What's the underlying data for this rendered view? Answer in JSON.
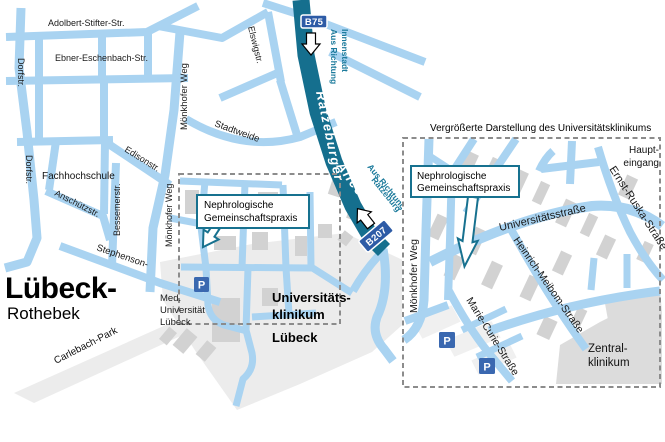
{
  "colors": {
    "road_light": "#a9d3f1",
    "road_dark": "#156f8e",
    "badge_blue": "#2d5ba6",
    "teal_text": "#1b7a9b",
    "callout_teal": "#17718f",
    "building_gray": "#d2d2d2",
    "campus_gray": "#ececec",
    "parking_blue": "#3a68b0"
  },
  "main_map": {
    "city_label": {
      "title": "Lübeck-",
      "subtitle": "Rothebek"
    },
    "streets": {
      "adolbert": "Adolbert-Stifter-Str.",
      "ebner": "Ebner-Eschenbach-Str.",
      "dorfstr_top": "Dorfstr.",
      "dorfstr_mid": "Dorfstr.",
      "moenkhofer_top": "Mönkhofer Weg",
      "moenkhofer_mid": "Mönkhofer Weg",
      "elswigstr": "Elswigstr.",
      "stadtweide": "Stadtweide",
      "edisonstr": "Edisonstr.",
      "bessemerstr": "Bessemerstr.",
      "anschuetzstr": "Anschützstr.",
      "stephenson": "Stephenson-",
      "ratzeburger": "Ratzeburger",
      "allee": "Allee",
      "carlebach_park": "Carlebach-Park"
    },
    "places": {
      "fachhochschule": "Fachhochschule",
      "med_uni_l1": "Med.",
      "med_uni_l2": "Universität",
      "med_uni_l3": "Lübeck",
      "klinikum_l1": "Universitäts-",
      "klinikum_l2": "klinikum",
      "klinikum_l3": "Lübeck"
    },
    "badges": {
      "b75": "B75",
      "b207": "B207"
    },
    "direction_innenstadt_l1": "Aus Richtung",
    "direction_innenstadt_l2": "Innenstadt",
    "direction_ratzeburg_l1": "Aus Richtung",
    "direction_ratzeburg_l2": "Ratzeburg",
    "callout_l1": "Nephrologische",
    "callout_l2": "Gemeinschaftspraxis",
    "parking_symbol": "P"
  },
  "inset": {
    "title": "Vergrößerte Darstellung des Universitätsklinikums",
    "callout_l1": "Nephrologische",
    "callout_l2": "Gemeinschaftspraxis",
    "streets": {
      "moenkhofer": "Mönkhofer Weg",
      "universitaetsstrasse": "Universitätsstraße",
      "ernst_ruska": "Ernst-Ruska-Straße",
      "heinrich_meibom": "Heinrich-Meibom-Straße",
      "marie_curie": "Marie-Curie-Straße"
    },
    "places": {
      "haupteingang_l1": "Haupt-",
      "haupteingang_l2": "eingang",
      "zentralklinikum_l1": "Zentral-",
      "zentralklinikum_l2": "klinikum"
    },
    "parking_symbol": "P"
  }
}
